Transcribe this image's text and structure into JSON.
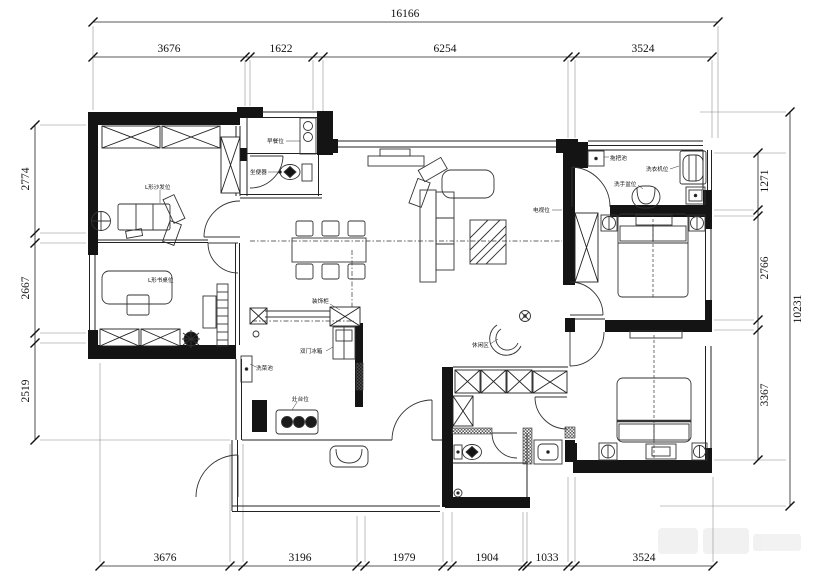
{
  "dimensions": {
    "top": {
      "total": "16166",
      "segments": [
        "3676",
        "1622",
        "6254",
        "3524"
      ]
    },
    "bottom": {
      "segments": [
        "3676",
        "3196",
        "1979",
        "1904",
        "1033",
        "3524"
      ]
    },
    "left": {
      "segments": [
        "2774",
        "2667",
        "2519"
      ]
    },
    "right": {
      "segments": [
        "1271",
        "2766",
        "3367"
      ],
      "total": "10231"
    }
  },
  "room_labels": {
    "sofa": "L形沙发位",
    "desk": "L形书桌位",
    "breakfast": "早餐位",
    "toilet": "坐便器",
    "decor_cabinet": "装饰柜",
    "fridge": "双门冰箱",
    "veg_sink": "洗菜池",
    "stove": "灶台位",
    "tv": "电视位",
    "leisure": "休闲区",
    "mop_pool": "拖把池",
    "washer": "洗衣机位",
    "basin": "洗手盆位"
  }
}
